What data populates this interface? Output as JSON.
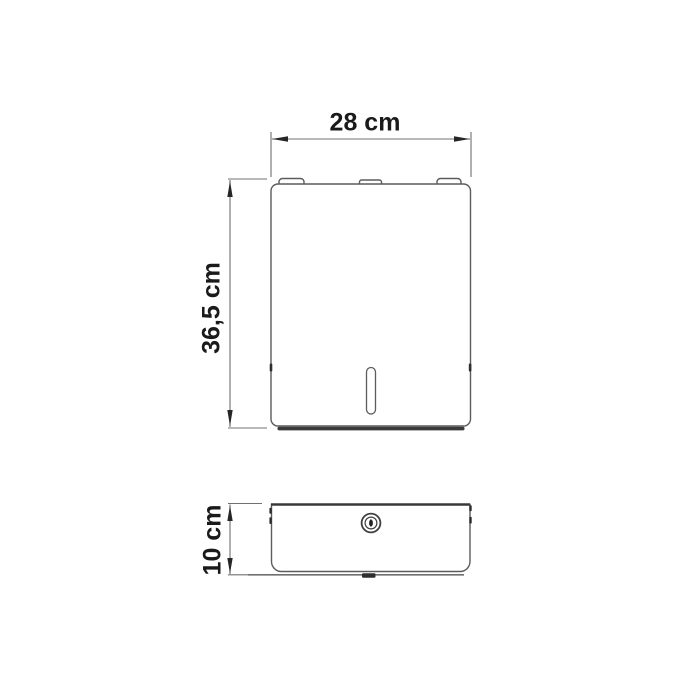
{
  "views": {
    "front": {
      "width_label": "28 cm",
      "height_label": "36,5 cm"
    },
    "bottom": {
      "depth_label": "10 cm"
    }
  },
  "icons": {
    "lock": "lock-keyhole-icon"
  },
  "colors": {
    "background": "#ffffff",
    "outline": "#5c5c5c",
    "dimension_line": "#707070",
    "arrow": "#262626",
    "text": "#1a1a1a",
    "dark_detail": "#333333"
  }
}
